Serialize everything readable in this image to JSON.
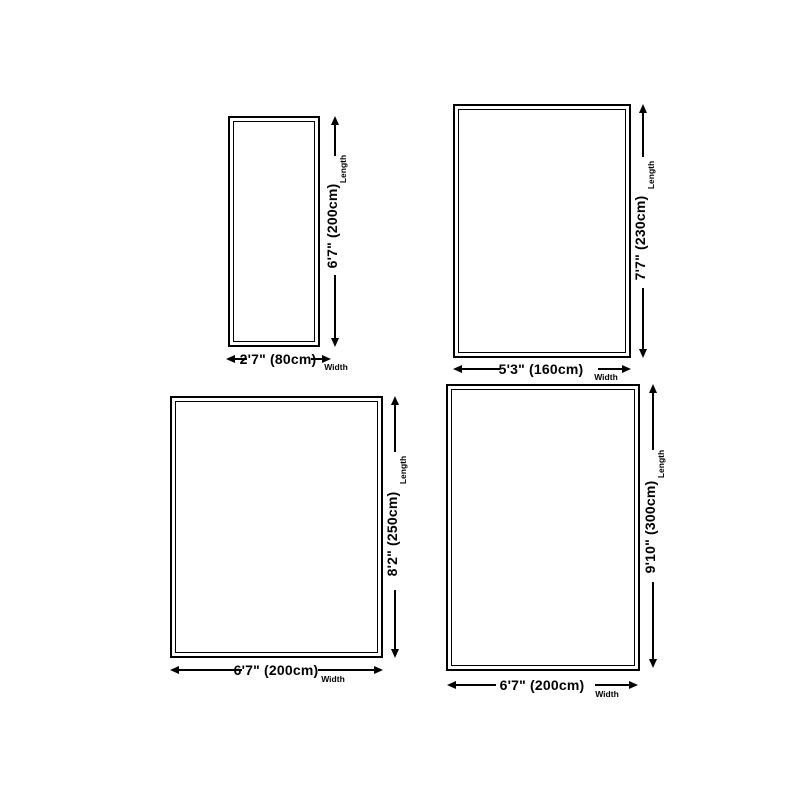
{
  "page": {
    "background_color": "#ffffff",
    "line_color": "#000000"
  },
  "annotation_labels": {
    "length": "Length",
    "width": "Width"
  },
  "sizes": [
    {
      "name": "2'7\" x 6'7\" (80cm x 200cm)",
      "width_label": "2'7\" (80cm)",
      "length_label": "6'7\" (200cm)",
      "width_imperial": "2'7\"",
      "width_cm": 80,
      "length_imperial": "6'7\"",
      "length_cm": 200
    },
    {
      "name": "5'3\" x 7'7\" (160cm x 230cm)",
      "width_label": "5'3\" (160cm)",
      "length_label": "7'7\" (230cm)",
      "width_imperial": "5'3\"",
      "width_cm": 160,
      "length_imperial": "7'7\"",
      "length_cm": 230
    },
    {
      "name": "6'7\" x 8'2\" (200cm x 250cm)",
      "width_label": "6'7\" (200cm)",
      "length_label": "8'2\" (250cm)",
      "width_imperial": "6'7\"",
      "width_cm": 200,
      "length_imperial": "8'2\"",
      "length_cm": 250
    },
    {
      "name": "6'7\" x 9'10\" (200cm x 300cm)",
      "width_label": "6'7\" (200cm)",
      "length_label": "9'10\" (300cm)",
      "width_imperial": "6'7\"",
      "width_cm": 200,
      "length_imperial": "9'10\"",
      "length_cm": 300
    }
  ]
}
